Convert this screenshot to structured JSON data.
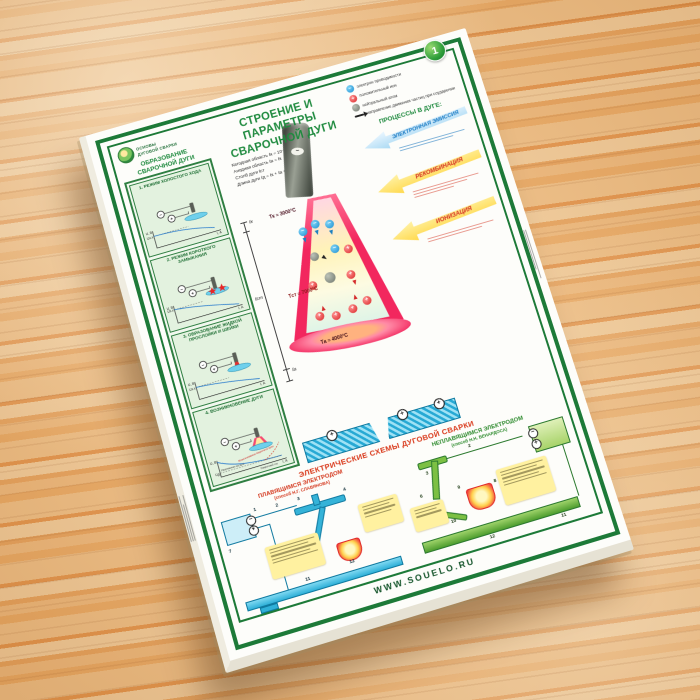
{
  "header": {
    "badge": "1",
    "brand_line1": "ОСНОВЫ",
    "brand_line2": "ДУГОВОЙ СВАРКИ",
    "title_line1": "СТРОЕНИЕ И ПАРАМЕТРЫ",
    "title_line2": "СВАРОЧНОЙ ДУГИ"
  },
  "arc_formation": {
    "heading": "ОБРАЗОВАНИЕ СВАРОЧНОЙ ДУГИ",
    "axis": {
      "y": "U, В",
      "x": "I, А"
    },
    "panels": [
      {
        "title": "1. РЕЖИМ ХОЛОСТОГО ХОДА",
        "level": "Uх.х"
      },
      {
        "title": "2. РЕЖИМ КОРОТКОГО ЗАМЫКАНИЯ",
        "level": "Uх.х"
      },
      {
        "title": "3. ОБРАЗОВАНИЕ ЖИДКОЙ ПРОСЛОЙКИ И ШЕЙКИ",
        "level": "Uх.х"
      },
      {
        "title": "4. ВОЗНИКНОВЕНИЕ ДУГИ",
        "level": "Uд",
        "note": "Напряжение на дуге",
        "annotation": "Возникновение сварочной дуги",
        "x_caption": "Сварочный ток"
      }
    ]
  },
  "formulas": [
    "Катодная область ℓк = 10⁻⁵..10⁻⁴ см",
    "Анодная область ℓа = ℓк",
    "Столб дуги ℓст",
    "Длина дуги ℓд = ℓк + ℓа + ℓст"
  ],
  "dimensions": {
    "cathode": "ℓк",
    "column": "ℓст",
    "anode": "ℓа"
  },
  "temperatures": {
    "cathode": "Tк ≈ 3000°C",
    "column": "Tст ≈ 7000°C",
    "anode": "Tа ≈ 4000°C"
  },
  "legend": {
    "items": [
      {
        "label": "электрон проводимости"
      },
      {
        "label": "положительный ион"
      },
      {
        "label": "нейтральный атом"
      },
      {
        "label": "направление движения частиц при соударении"
      }
    ]
  },
  "processes": {
    "heading": "ПРОЦЕССЫ В ДУГЕ:",
    "emission": "ЭЛЕКТРОННАЯ ЭМИССИЯ",
    "recombination": "РЕКОМБИНАЦИЯ",
    "ionization": "ИОНИЗАЦИЯ"
  },
  "schemes": {
    "heading": "ЭЛЕКТРИЧЕСКИЕ СХЕМЫ ДУГОВОЙ СВАРКИ",
    "left": {
      "title": "ПЛАВЯЩИМСЯ ЭЛЕКТРОДОМ",
      "subtitle": "(способ Н.Г. СЛАВЯНОВА)",
      "callouts": [
        "1",
        "2",
        "3",
        "4",
        "7",
        "11",
        "12"
      ]
    },
    "right": {
      "title": "НЕПЛАВЯЩИМСЯ ЭЛЕКТРОДОМ",
      "subtitle": "(способ Н.Н. БЕНАРДОСА)",
      "callouts": [
        "2",
        "3",
        "6",
        "8",
        "9",
        "10",
        "11",
        "12"
      ]
    }
  },
  "footer": {
    "website": "WWW.SOUELO.RU"
  },
  "symbols": {
    "minus": "−",
    "plus": "+"
  },
  "colors": {
    "frame_green": "#1d7a38",
    "title_green": "#1e8a3e",
    "scheme_red": "#d93a1c",
    "banner_blue": "#1f8ac9",
    "arrow_yellow": "#ffd84a",
    "arc_pink": "#f2275e"
  }
}
